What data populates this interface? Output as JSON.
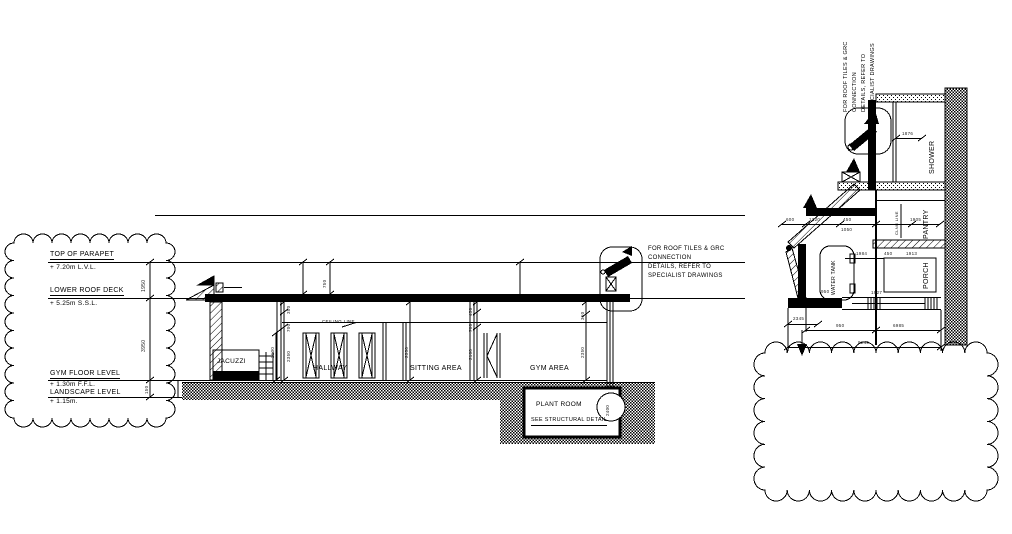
{
  "levels": [
    {
      "label": "TOP OF PARAPET",
      "value": "+ 7.20m L.V.L."
    },
    {
      "label": "LOWER ROOF DECK",
      "value": "+ 5.25m S.S.L."
    },
    {
      "label": "GYM FLOOR LEVEL",
      "value": "+ 1.30m F.F.L."
    },
    {
      "label": "LANDSCAPE LEVEL",
      "value": "+ 1.15m."
    }
  ],
  "rooms": {
    "jacuzzi": "JACUZZI",
    "hallway": "HALLWAY",
    "sitting_area": "SITTING AREA",
    "gym_area": "GYM AREA",
    "plant_room": "PLANT ROOM",
    "plant_room_note": "SEE STRUCTURAL DETAIL",
    "ceiling_line": "CEILING LINE",
    "shower": "SHOWER",
    "pantry": "PANTRY",
    "porch": "PORCH",
    "water_tank": "WATER TANK",
    "clng_line": "CLNG LINE"
  },
  "roof_note": {
    "line1": "FOR ROOF TILES & GRC",
    "line2": "CONNECTION",
    "line3": "DETAILS, REFER TO",
    "line4": "SPECIALIST DRAWINGS"
  },
  "dims_main": {
    "parapet_height": "750",
    "parapet_to_roof": "1950",
    "roof_to_floor": "3950",
    "floor_step": "150",
    "hall_wall": "2100",
    "col_a": [
      "350",
      "700",
      "2350"
    ],
    "hall_opening": "2350",
    "col_b": [
      "450",
      "700",
      "2100"
    ],
    "col_c": [
      "350",
      "2350"
    ],
    "plant_depth": "2400"
  },
  "dims_detail": {
    "top_row": [
      "600",
      "1320",
      "450",
      "1905"
    ],
    "shower_width": "1876",
    "porch_row": [
      "1984",
      "450",
      "1913"
    ],
    "tank_width": "1050",
    "tank_height": "950",
    "beam": "1927",
    "tank_base": "2345",
    "bottom_row1": [
      "950",
      "6985"
    ],
    "bottom_row2": "9245"
  },
  "colors": {
    "ink": "#000000",
    "paper": "#ffffff"
  }
}
